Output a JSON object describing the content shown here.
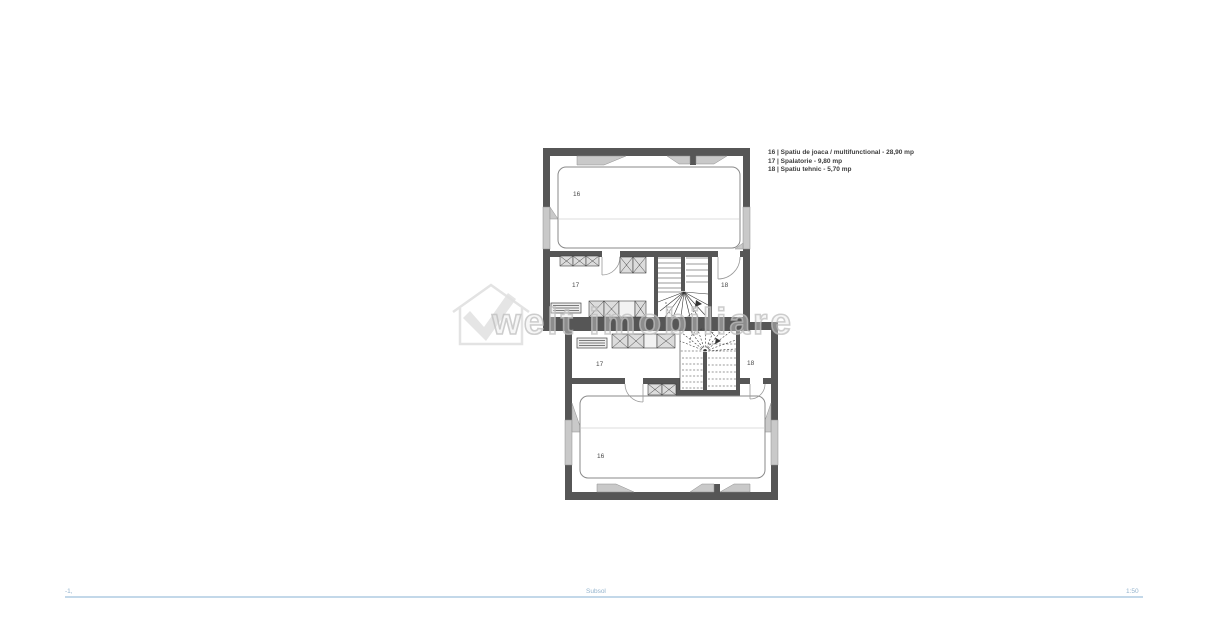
{
  "legend": {
    "items": [
      "16 | Spatiu de joaca / multifunctional - 28,90 mp",
      "17 | Spalatorie - 9,80 mp",
      "18 | Spatiu tehnic - 5,70 mp"
    ]
  },
  "plan": {
    "upper_unit": {
      "playroom": "16",
      "laundry": "17",
      "technical": "18"
    },
    "lower_unit": {
      "playroom": "16",
      "laundry": "17",
      "technical": "18"
    }
  },
  "watermark": {
    "text": "welt imobiliare"
  },
  "footer": {
    "level": "-1,",
    "title": "Subsol",
    "scale": "1:50"
  },
  "colors": {
    "wall": "#565656",
    "window": "#c9c9c9",
    "fixture": "#dcdcdc",
    "legend_text": "#3d3d3d",
    "footer_blue": "#93b3cd",
    "footer_line": "#c3d8e9",
    "watermark_gray": "#d6d6d6"
  }
}
